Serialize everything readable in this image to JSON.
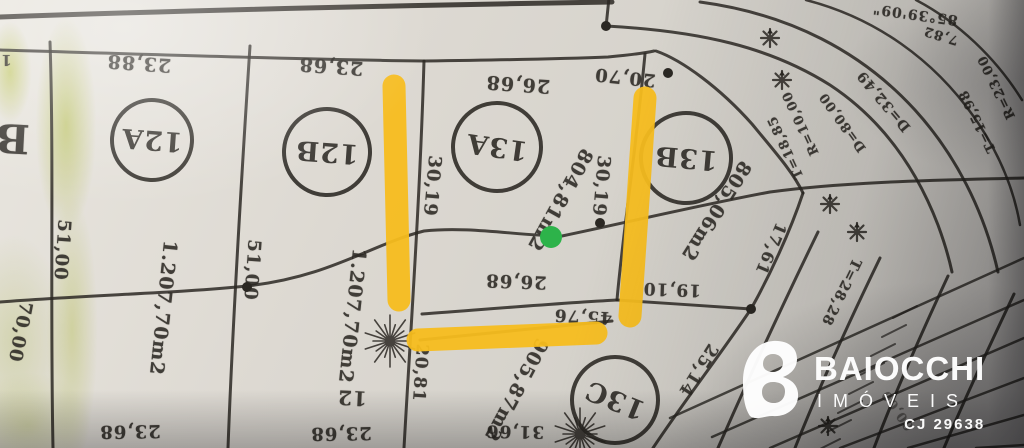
{
  "meta": {
    "description": "Scanned subdivision plat map (loteamento) with lot numbers, dimensions in meters and areas in m2; drawing appears rotated 180 degrees; annotated with highlighter and a green dot",
    "language": "pt-BR"
  },
  "watermark": {
    "brand": "BAIOCCHI",
    "subbrand": "IMÓVEIS",
    "license": "CJ 29638",
    "logo_icon": "baiocchi-b-heart-logo",
    "color": "#ffffff"
  },
  "annotations": {
    "highlighter_color": "#f7bd1d",
    "green_dot_color": "#2db34a",
    "green_highlight_color": "#c8d45f",
    "green_dot": {
      "x": 551,
      "y": 237,
      "r": 11
    },
    "highlight_strokes": [
      {
        "name": "vertical-left-of-lot-13A",
        "x1": 394,
        "y1": 86,
        "x2": 399,
        "y2": 300
      },
      {
        "name": "vertical-right-of-lot-13A",
        "x1": 645,
        "y1": 98,
        "x2": 630,
        "y2": 316
      },
      {
        "name": "horizontal-below-lot-13A",
        "x1": 418,
        "y1": 340,
        "x2": 596,
        "y2": 333
      }
    ]
  },
  "map": {
    "ink_color": "#2b2823",
    "lots": [
      {
        "id": "12A",
        "area": "1.207,70m2",
        "front": "23,88",
        "side": "51,00"
      },
      {
        "id": "12B",
        "area": "1.207,70m2",
        "front": "23,68",
        "side": "51,00"
      },
      {
        "id": "13A",
        "area": "804,81m2",
        "front": "26,68",
        "back": "26,68",
        "side_left": "30,19",
        "side_right": "30,19"
      },
      {
        "id": "13B",
        "area": "805,06m2",
        "top": "20,70",
        "bottom": "19,10",
        "side": "17,61"
      },
      {
        "id": "13C",
        "area": "905,87m2",
        "edges": [
          "45,76",
          "20,81",
          "25,14",
          "31,66"
        ]
      },
      {
        "id": "B",
        "partial": true
      },
      {
        "id": "12",
        "partial": true
      }
    ],
    "curve_data": [
      "R=10,00",
      "T=18,85",
      "D=32,49",
      "D=80,00",
      "85°39'09\"",
      "7,82",
      "R=23,00",
      "T=15,98",
      "T=28,28"
    ],
    "labels": [
      {
        "text": "23,88",
        "x": 139,
        "y": 63,
        "rot": 184,
        "fs": 19
      },
      {
        "text": "23,68",
        "x": 331,
        "y": 66,
        "rot": 184,
        "fs": 19
      },
      {
        "text": "26,68",
        "x": 518,
        "y": 84,
        "rot": 184,
        "fs": 19
      },
      {
        "text": "20,70",
        "x": 625,
        "y": 77,
        "rot": 186,
        "fs": 18
      },
      {
        "text": "30,19",
        "x": 432,
        "y": 186,
        "rot": 95,
        "fs": 18
      },
      {
        "text": "30,19",
        "x": 601,
        "y": 186,
        "rot": 95,
        "fs": 18
      },
      {
        "text": "51,00",
        "x": 62,
        "y": 250,
        "rot": 94,
        "fs": 18
      },
      {
        "text": "51,00",
        "x": 252,
        "y": 270,
        "rot": 94,
        "fs": 18
      },
      {
        "text": "70,00",
        "x": 20,
        "y": 332,
        "rot": 101,
        "fs": 18
      },
      {
        "text": "1.207,70m2",
        "x": 163,
        "y": 308,
        "rot": 96,
        "fs": 19
      },
      {
        "text": "1.207,70m2",
        "x": 352,
        "y": 316,
        "rot": 96,
        "fs": 19
      },
      {
        "text": "804,81m2",
        "x": 560,
        "y": 200,
        "rot": 119,
        "fs": 19
      },
      {
        "text": "805,06m2",
        "x": 716,
        "y": 211,
        "rot": 122,
        "fs": 19
      },
      {
        "text": "905,87m2",
        "x": 516,
        "y": 390,
        "rot": 118,
        "fs": 19
      },
      {
        "text": "26,68",
        "x": 516,
        "y": 281,
        "rot": 182,
        "fs": 18
      },
      {
        "text": "45,76",
        "x": 583,
        "y": 316,
        "rot": 183,
        "fs": 17
      },
      {
        "text": "19,10",
        "x": 672,
        "y": 289,
        "rot": 182,
        "fs": 17
      },
      {
        "text": "20,81",
        "x": 420,
        "y": 373,
        "rot": 94,
        "fs": 17
      },
      {
        "text": "25,14",
        "x": 698,
        "y": 370,
        "rot": 122,
        "fs": 17
      },
      {
        "text": "17,61",
        "x": 771,
        "y": 249,
        "rot": 113,
        "fs": 16
      },
      {
        "text": "31,66",
        "x": 515,
        "y": 431,
        "rot": 181,
        "fs": 17
      },
      {
        "text": "23,68",
        "x": 130,
        "y": 431,
        "rot": 179,
        "fs": 18
      },
      {
        "text": "23,68",
        "x": 341,
        "y": 433,
        "rot": 179,
        "fs": 18
      },
      {
        "text": "12",
        "x": 352,
        "y": 398,
        "rot": 183,
        "fs": 20
      },
      {
        "text": "B",
        "x": 12,
        "y": 138,
        "rot": 183,
        "fs": 40
      },
      {
        "text": "1",
        "x": 6,
        "y": 60,
        "rot": 180,
        "fs": 15
      },
      {
        "text": "R=10,00",
        "x": 801,
        "y": 123,
        "rot": 245,
        "fs": 13
      },
      {
        "text": "T=18,85",
        "x": 786,
        "y": 147,
        "rot": 245,
        "fs": 13
      },
      {
        "text": "D=32,49",
        "x": 884,
        "y": 101,
        "rot": 230,
        "fs": 14
      },
      {
        "text": "D=80,00",
        "x": 843,
        "y": 122,
        "rot": 234,
        "fs": 13
      },
      {
        "text": "R=23,00",
        "x": 997,
        "y": 87,
        "rot": 244,
        "fs": 13
      },
      {
        "text": "T=15,98",
        "x": 978,
        "y": 121,
        "rot": 244,
        "fs": 13
      },
      {
        "text": "85°39'09\"",
        "x": 915,
        "y": 14,
        "rot": 188,
        "fs": 14
      },
      {
        "text": "7,82",
        "x": 941,
        "y": 35,
        "rot": 197,
        "fs": 13
      },
      {
        "text": "T=28,28",
        "x": 841,
        "y": 292,
        "rot": 116,
        "fs": 14
      },
      {
        "text": "00,00",
        "x": 898,
        "y": 410,
        "rot": 235,
        "fs": 13,
        "op": 0.5
      }
    ],
    "circles": [
      {
        "id": "12A",
        "x": 152,
        "y": 140,
        "r": 42,
        "rot": 184,
        "fs": 27
      },
      {
        "id": "12B",
        "x": 327,
        "y": 152,
        "r": 45,
        "rot": 184,
        "fs": 27
      },
      {
        "id": "13A",
        "x": 497,
        "y": 147,
        "r": 46,
        "rot": 188,
        "fs": 27
      },
      {
        "id": "13B",
        "x": 686,
        "y": 158,
        "r": 47,
        "rot": 185,
        "fs": 27
      },
      {
        "id": "13C",
        "x": 615,
        "y": 400,
        "r": 45,
        "rot": 202,
        "fs": 27
      }
    ],
    "symbols": {
      "survey_stars": [
        [
          770,
          38
        ],
        [
          782,
          80
        ],
        [
          830,
          204
        ],
        [
          857,
          232
        ],
        [
          828,
          426
        ]
      ],
      "sunbursts": [
        [
          390,
          341
        ],
        [
          580,
          434
        ]
      ],
      "nodes": [
        [
          606,
          26
        ],
        [
          247,
          287
        ],
        [
          600,
          223
        ],
        [
          751,
          309
        ],
        [
          668,
          73
        ]
      ]
    }
  }
}
